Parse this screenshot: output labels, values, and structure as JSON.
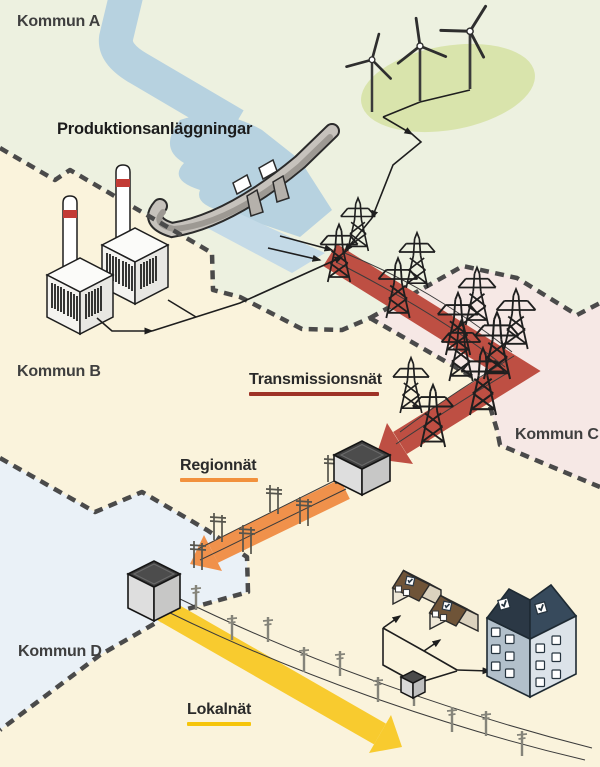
{
  "diagram": {
    "municipalities": [
      {
        "label": "Kommun A"
      },
      {
        "label": "Kommun B"
      },
      {
        "label": "Kommun C"
      },
      {
        "label": "Kommun D"
      }
    ],
    "production_label": "Produktionsanläggningar",
    "networks": [
      {
        "label": "Transmissionsnät",
        "color": "#BE4F43",
        "underline_color": "#9E3226"
      },
      {
        "label": "Regionnät",
        "color": "#F0914B",
        "underline_color": "#F2913D"
      },
      {
        "label": "Lokalnät",
        "color": "#F8CB2F",
        "underline_color": "#F6C50B"
      }
    ],
    "colors": {
      "kommun_a_bg": "#EDF1E0",
      "kommun_b_bg": "#FAF3DC",
      "kommun_c_bg": "#F6E8E5",
      "kommun_d_bg": "#EAF1F7",
      "water": "#B7D2E0",
      "tailwater": "#C4DAE7",
      "windfarm_green": "#D9E4AC",
      "boundary_gray": "#4A4A4A"
    }
  }
}
